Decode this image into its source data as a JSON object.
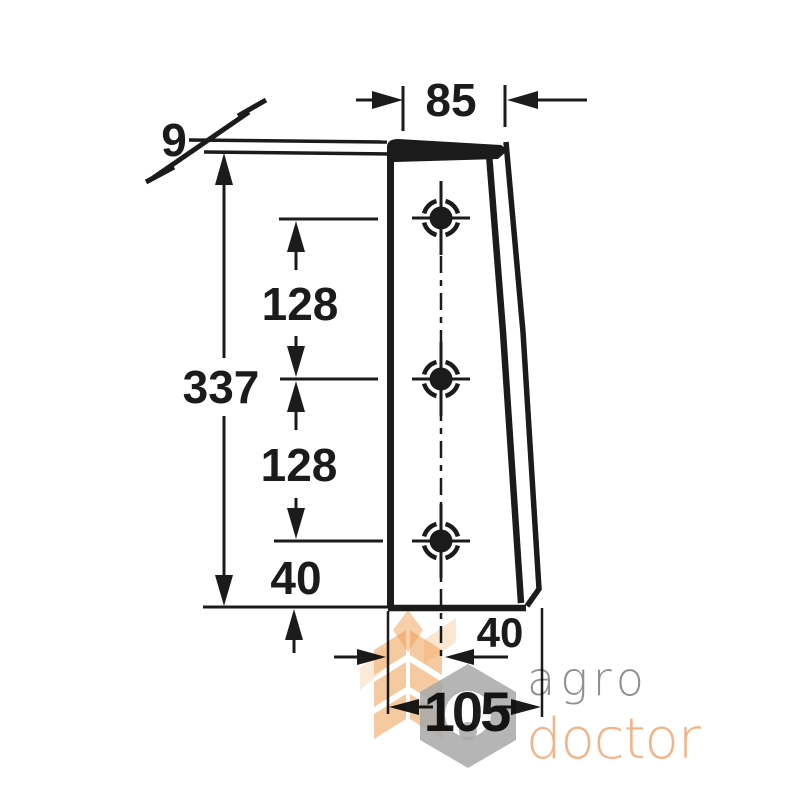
{
  "drawing": {
    "title_hint": "technical dimension drawing of tapered blade",
    "dimensions": {
      "top_width": "85",
      "thickness": "9",
      "total_height": "337",
      "hole_spacing_upper": "128",
      "hole_spacing_lower": "128",
      "bottom_hole_offset": "40",
      "centerline_offset": "40",
      "bottom_width": "105"
    },
    "hole_count": 3,
    "line_color": "#1b1b1b"
  },
  "watermark": {
    "brand_top": "agro",
    "brand_bottom": "doctor",
    "colors": {
      "brand_top_text": "#8f8f8f",
      "brand_bottom_text": "#f5b286",
      "wheat": "#ef9f54",
      "hexagon": "#a8a8a8"
    }
  }
}
